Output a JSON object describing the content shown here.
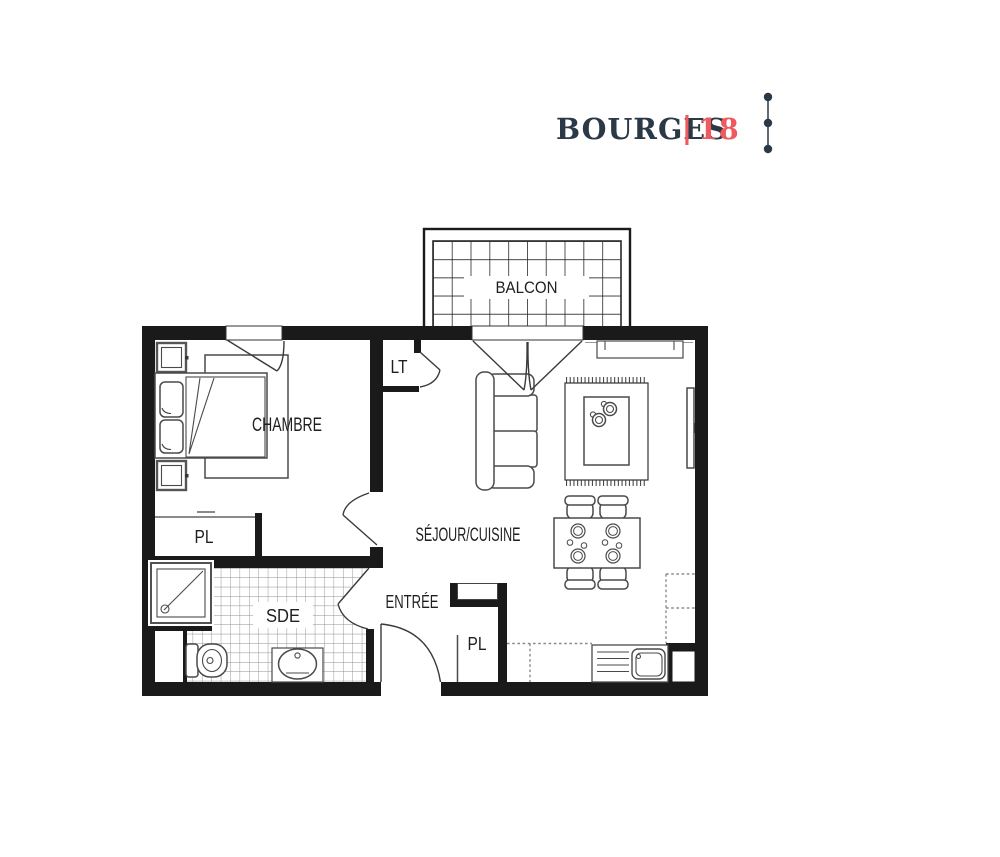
{
  "header": {
    "city": "BOURGES",
    "separator": "|",
    "number": "18"
  },
  "labels": {
    "balcony": "BALCON",
    "bedroom": "CHAMBRE",
    "closet_lt": "LT",
    "living_kitchen": "SÉJOUR/CUISINE",
    "closet_bedroom": "PL",
    "bathroom": "SDE",
    "entry": "ENTRÉE",
    "closet_entry": "PL"
  },
  "colors": {
    "navy": "#2b3947",
    "red": "#ee5a5f",
    "wall": "#1a1a1a",
    "furniture": "#4a4a4a",
    "text": "#1f1f1f"
  }
}
